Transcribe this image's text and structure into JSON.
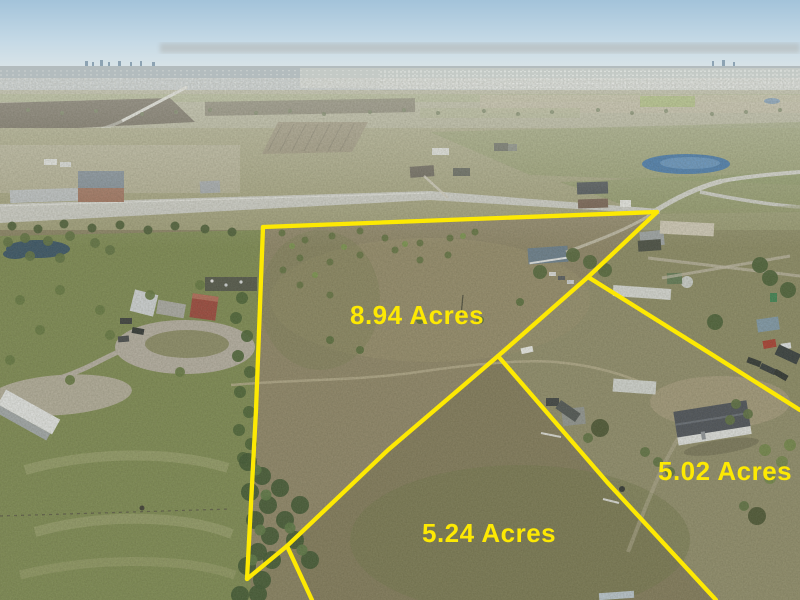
{
  "photo": {
    "description": "Aerial drone photo of rural land for sale with three outlined parcels",
    "labels": {
      "parcel_894": "8.94 Acres",
      "parcel_524": "5.24 Acres",
      "parcel_502": "5.02 Acres"
    },
    "colors": {
      "boundary_line": "#fde903",
      "label_text": "#fde903",
      "sky_top": "#a3c3da",
      "sky_horizon": "#e0e7e8",
      "field_olive": "#8c8365",
      "pasture_green": "#7d8a52",
      "road_gray": "#c6c7c0",
      "pond_blue": "#4f7fae"
    }
  }
}
